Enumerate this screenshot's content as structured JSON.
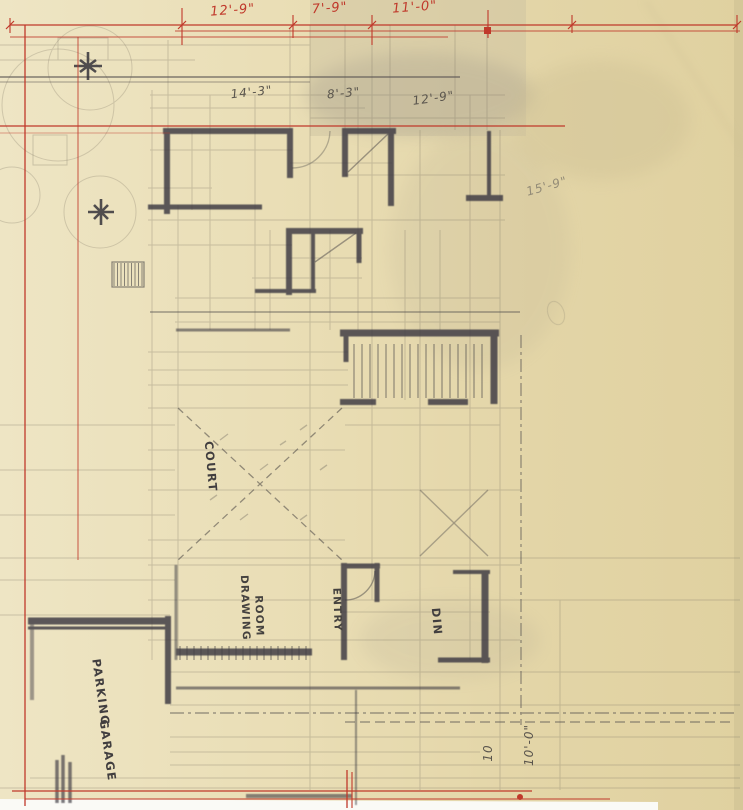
{
  "sheet": {
    "type_note": "hand-drawn architectural floor plan on yellow trace paper"
  },
  "colors": {
    "paper_light": "#eee5c4",
    "paper_mid": "#e7dab0",
    "paper_dark": "#ddcf9f",
    "red_ink": "#c0392b",
    "graphite_dark": "#3f3d45",
    "graphite_light": "#8d8673",
    "scan_white": "#fafaf6"
  },
  "dimensions": {
    "red": [
      {
        "label": "12'-9\""
      },
      {
        "label": "7'-9\""
      },
      {
        "label": "11'-0\""
      }
    ],
    "pencil": [
      {
        "label": "14'-3\""
      },
      {
        "label": "8'-3\""
      },
      {
        "label": "12'-9\""
      },
      {
        "label": "15'-9\""
      },
      {
        "label": "10'-0\""
      },
      {
        "label": "10"
      }
    ]
  },
  "rooms": {
    "court": "COURT",
    "drawing_room_line1": "DRAWING",
    "drawing_room_line2": "ROOM",
    "entry": "ENTRY",
    "dining": "DIN",
    "garage_line1": "PARKING",
    "garage_line2": "GARAGE"
  }
}
